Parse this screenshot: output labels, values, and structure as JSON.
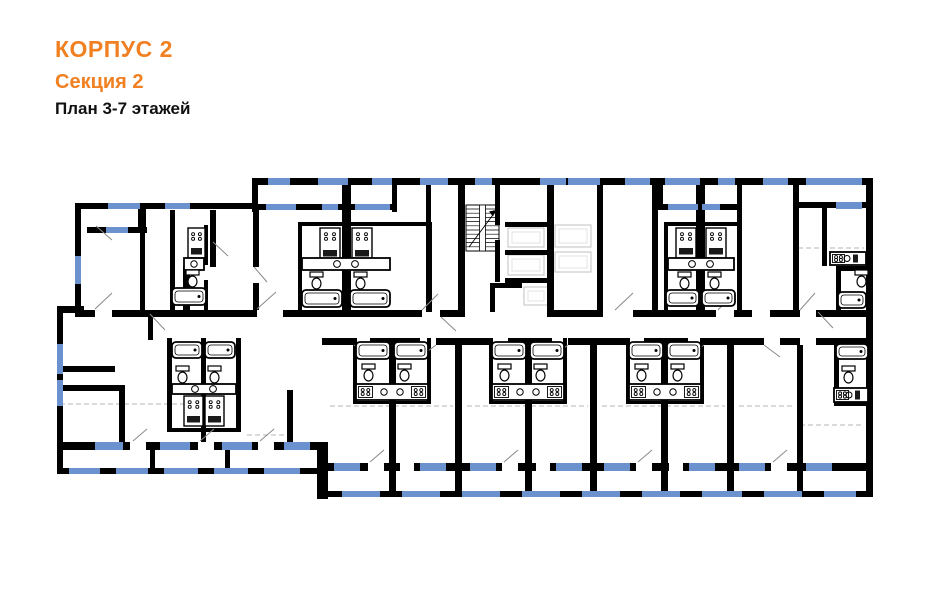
{
  "header": {
    "building": "КОРПУС 2",
    "section": "Секция 2",
    "floors": "План 3-7 этажей"
  },
  "colors": {
    "accent_orange": "#F08021",
    "wall_black": "#000000",
    "window_blue": "#6B92CF",
    "dash_gray": "#B5B5B5",
    "door_gray": "#8A8A8A",
    "lift_gray": "#C0C0C0",
    "lift_gray_light": "#DCDCDC",
    "background": "#FFFFFF"
  },
  "plan": {
    "canvas": {
      "w": 941,
      "h": 600
    },
    "walls": [
      [
        252,
        178,
        621,
        7
      ],
      [
        75,
        203,
        182,
        6
      ],
      [
        866,
        178,
        7,
        319
      ],
      [
        75,
        203,
        6,
        110
      ],
      [
        57,
        306,
        27,
        7
      ],
      [
        57,
        306,
        6,
        168
      ],
      [
        57,
        442,
        266,
        8
      ],
      [
        317,
        442,
        11,
        57
      ],
      [
        322,
        463,
        548,
        8
      ],
      [
        87,
        227,
        60,
        6
      ],
      [
        138,
        203,
        8,
        30
      ],
      [
        255,
        204,
        140,
        6
      ],
      [
        658,
        204,
        82,
        6
      ],
      [
        795,
        202,
        71,
        6
      ],
      [
        252,
        178,
        6,
        34
      ],
      [
        392,
        178,
        5,
        34
      ],
      [
        658,
        178,
        5,
        30
      ],
      [
        342,
        185,
        9,
        127
      ],
      [
        426,
        185,
        5,
        127
      ],
      [
        458,
        185,
        7,
        132
      ],
      [
        495,
        185,
        5,
        40
      ],
      [
        495,
        240,
        5,
        42
      ],
      [
        547,
        185,
        7,
        132
      ],
      [
        505,
        222,
        47,
        5
      ],
      [
        505,
        250,
        47,
        5
      ],
      [
        505,
        278,
        47,
        5
      ],
      [
        490,
        283,
        5,
        29
      ],
      [
        490,
        283,
        32,
        5
      ],
      [
        597,
        185,
        6,
        127
      ],
      [
        652,
        185,
        6,
        127
      ],
      [
        696,
        185,
        9,
        127
      ],
      [
        737,
        178,
        5,
        134
      ],
      [
        793,
        178,
        6,
        134
      ],
      [
        822,
        208,
        5,
        58
      ],
      [
        210,
        210,
        6,
        57
      ],
      [
        253,
        210,
        6,
        57
      ],
      [
        253,
        283,
        6,
        27
      ],
      [
        170,
        210,
        5,
        100
      ],
      [
        204,
        225,
        4,
        40
      ],
      [
        204,
        280,
        4,
        30
      ],
      [
        183,
        272,
        7,
        38
      ],
      [
        183,
        266,
        14,
        7
      ],
      [
        140,
        231,
        5,
        80
      ],
      [
        298,
        222,
        134,
        4
      ],
      [
        298,
        222,
        4,
        90
      ],
      [
        428,
        222,
        4,
        90
      ],
      [
        664,
        222,
        78,
        4
      ],
      [
        664,
        222,
        4,
        90
      ],
      [
        836,
        266,
        32,
        5
      ],
      [
        836,
        266,
        5,
        44
      ],
      [
        75,
        310,
        20,
        7
      ],
      [
        112,
        310,
        58,
        7
      ],
      [
        170,
        310,
        87,
        7
      ],
      [
        283,
        310,
        37,
        7
      ],
      [
        320,
        310,
        102,
        7
      ],
      [
        440,
        310,
        18,
        7
      ],
      [
        553,
        310,
        50,
        7
      ],
      [
        633,
        310,
        19,
        7
      ],
      [
        652,
        310,
        64,
        7
      ],
      [
        734,
        310,
        18,
        7
      ],
      [
        770,
        310,
        30,
        7
      ],
      [
        816,
        310,
        50,
        7
      ],
      [
        322,
        338,
        32,
        7
      ],
      [
        370,
        338,
        50,
        7
      ],
      [
        436,
        338,
        56,
        7
      ],
      [
        508,
        338,
        44,
        7
      ],
      [
        568,
        338,
        60,
        7
      ],
      [
        644,
        338,
        44,
        7
      ],
      [
        704,
        338,
        60,
        7
      ],
      [
        780,
        338,
        20,
        7
      ],
      [
        816,
        338,
        50,
        7
      ],
      [
        57,
        366,
        58,
        6
      ],
      [
        63,
        385,
        60,
        6
      ],
      [
        119,
        385,
        6,
        60
      ],
      [
        148,
        313,
        5,
        27
      ],
      [
        287,
        390,
        6,
        54
      ],
      [
        167,
        338,
        5,
        92
      ],
      [
        236,
        338,
        5,
        92
      ],
      [
        201,
        338,
        5,
        104
      ],
      [
        167,
        428,
        74,
        4
      ],
      [
        389,
        345,
        7,
        146
      ],
      [
        455,
        345,
        7,
        146
      ],
      [
        525,
        345,
        7,
        146
      ],
      [
        590,
        345,
        7,
        146
      ],
      [
        661,
        345,
        7,
        146
      ],
      [
        727,
        345,
        7,
        146
      ],
      [
        797,
        345,
        6,
        146
      ],
      [
        834,
        338,
        5,
        66
      ],
      [
        353,
        338,
        4,
        65
      ],
      [
        427,
        338,
        4,
        65
      ],
      [
        353,
        401,
        78,
        3
      ],
      [
        489,
        338,
        4,
        65
      ],
      [
        563,
        338,
        4,
        65
      ],
      [
        489,
        401,
        78,
        3
      ],
      [
        626,
        338,
        4,
        65
      ],
      [
        700,
        338,
        4,
        65
      ],
      [
        626,
        401,
        78,
        3
      ],
      [
        834,
        402,
        36,
        4
      ],
      [
        150,
        450,
        5,
        18
      ],
      [
        225,
        450,
        5,
        18
      ]
    ],
    "gaps": [
      [
        130,
        442,
        16,
        8
      ],
      [
        198,
        442,
        16,
        8
      ],
      [
        258,
        442,
        16,
        8
      ],
      [
        368,
        463,
        16,
        8
      ],
      [
        400,
        463,
        14,
        8
      ],
      [
        502,
        463,
        16,
        8
      ],
      [
        536,
        463,
        14,
        8
      ],
      [
        636,
        463,
        16,
        8
      ],
      [
        669,
        463,
        14,
        8
      ],
      [
        771,
        463,
        16,
        8
      ]
    ],
    "glazing": [
      [
        57,
        468,
        266,
        6
      ],
      [
        322,
        491,
        551,
        6
      ]
    ],
    "windows": [
      [
        268,
        178,
        22,
        7
      ],
      [
        318,
        178,
        30,
        7
      ],
      [
        372,
        178,
        20,
        7
      ],
      [
        420,
        178,
        28,
        7
      ],
      [
        475,
        178,
        17,
        7
      ],
      [
        540,
        178,
        26,
        7
      ],
      [
        568,
        178,
        32,
        7
      ],
      [
        625,
        178,
        25,
        7
      ],
      [
        665,
        178,
        35,
        7
      ],
      [
        718,
        178,
        17,
        7
      ],
      [
        763,
        178,
        25,
        7
      ],
      [
        806,
        178,
        56,
        7
      ],
      [
        108,
        203,
        32,
        6
      ],
      [
        165,
        203,
        25,
        6
      ],
      [
        266,
        204,
        30,
        6
      ],
      [
        322,
        204,
        16,
        6
      ],
      [
        355,
        204,
        35,
        6
      ],
      [
        668,
        204,
        30,
        6
      ],
      [
        702,
        204,
        18,
        6
      ],
      [
        836,
        202,
        26,
        7
      ],
      [
        106,
        227,
        22,
        6
      ],
      [
        75,
        256,
        6,
        28
      ],
      [
        57,
        344,
        6,
        30
      ],
      [
        57,
        380,
        6,
        26
      ],
      [
        95,
        442,
        28,
        8
      ],
      [
        160,
        442,
        30,
        8
      ],
      [
        222,
        442,
        30,
        8
      ],
      [
        284,
        442,
        26,
        8
      ],
      [
        334,
        463,
        26,
        8
      ],
      [
        420,
        463,
        26,
        8
      ],
      [
        470,
        463,
        26,
        8
      ],
      [
        556,
        463,
        26,
        8
      ],
      [
        604,
        463,
        26,
        8
      ],
      [
        689,
        463,
        26,
        8
      ],
      [
        739,
        463,
        26,
        8
      ],
      [
        806,
        463,
        26,
        8
      ]
    ],
    "posts": [
      [
        57,
        468,
        12,
        6
      ],
      [
        100,
        468,
        16,
        6
      ],
      [
        148,
        468,
        16,
        6
      ],
      [
        198,
        468,
        16,
        6
      ],
      [
        248,
        468,
        16,
        6
      ],
      [
        300,
        468,
        23,
        6
      ],
      [
        322,
        491,
        20,
        6
      ],
      [
        380,
        491,
        22,
        6
      ],
      [
        440,
        491,
        22,
        6
      ],
      [
        500,
        491,
        22,
        6
      ],
      [
        560,
        491,
        22,
        6
      ],
      [
        620,
        491,
        22,
        6
      ],
      [
        680,
        491,
        22,
        6
      ],
      [
        742,
        491,
        22,
        6
      ],
      [
        802,
        491,
        22,
        6
      ],
      [
        856,
        491,
        17,
        6
      ]
    ],
    "dashes": [
      [
        60,
        404,
        192,
        404
      ],
      [
        247,
        435,
        290,
        435
      ],
      [
        330,
        406,
        453,
        406
      ],
      [
        467,
        406,
        588,
        406
      ],
      [
        602,
        406,
        725,
        406
      ],
      [
        739,
        406,
        795,
        406
      ],
      [
        800,
        425,
        864,
        425
      ],
      [
        798,
        248,
        864,
        248
      ]
    ],
    "doors": [
      [
        95,
        309,
        112,
        293
      ],
      [
        257,
        309,
        276,
        292
      ],
      [
        267,
        282,
        254,
        267
      ],
      [
        422,
        310,
        438,
        294
      ],
      [
        441,
        317,
        456,
        331
      ],
      [
        615,
        310,
        633,
        293
      ],
      [
        718,
        310,
        733,
        294
      ],
      [
        800,
        310,
        815,
        293
      ],
      [
        354,
        345,
        370,
        357
      ],
      [
        420,
        357,
        436,
        345
      ],
      [
        493,
        345,
        509,
        357
      ],
      [
        552,
        357,
        568,
        345
      ],
      [
        630,
        345,
        646,
        357
      ],
      [
        688,
        357,
        704,
        345
      ],
      [
        764,
        345,
        780,
        357
      ],
      [
        133,
        441,
        147,
        429
      ],
      [
        200,
        441,
        214,
        429
      ],
      [
        260,
        441,
        274,
        429
      ],
      [
        370,
        462,
        384,
        450
      ],
      [
        504,
        462,
        518,
        450
      ],
      [
        638,
        462,
        652,
        450
      ],
      [
        773,
        462,
        787,
        450
      ],
      [
        213,
        242,
        228,
        256
      ],
      [
        150,
        314,
        165,
        330
      ],
      [
        96,
        226,
        112,
        240
      ],
      [
        818,
        312,
        833,
        328
      ]
    ],
    "lifts": [
      [
        508,
        228,
        36,
        19
      ],
      [
        508,
        255,
        36,
        20
      ],
      [
        555,
        225,
        36,
        22
      ],
      [
        555,
        252,
        36,
        20
      ],
      [
        524,
        287,
        24,
        18
      ]
    ],
    "stair": {
      "x": 466,
      "y": 205,
      "w": 33,
      "h": 46
    },
    "fixtures": [
      [
        "stove",
        188,
        228,
        17,
        30
      ],
      [
        "stove",
        320,
        228,
        20,
        32
      ],
      [
        "stove",
        352,
        228,
        20,
        32
      ],
      [
        "stove",
        676,
        228,
        20,
        30
      ],
      [
        "stove",
        706,
        228,
        20,
        30
      ],
      [
        "stove",
        184,
        396,
        19,
        30
      ],
      [
        "stove",
        205,
        396,
        19,
        30
      ],
      [
        "counter",
        184,
        258,
        20,
        12,
        0
      ],
      [
        "counter",
        302,
        258,
        88,
        12,
        1
      ],
      [
        "counter",
        668,
        258,
        66,
        12,
        1
      ],
      [
        "counter",
        830,
        252,
        36,
        13,
        3
      ],
      [
        "counter",
        356,
        384,
        72,
        16,
        2
      ],
      [
        "counter",
        492,
        384,
        72,
        16,
        2
      ],
      [
        "counter",
        629,
        384,
        72,
        16,
        2
      ],
      [
        "counter",
        834,
        388,
        34,
        14,
        3
      ],
      [
        "counter",
        172,
        384,
        64,
        10,
        1
      ],
      [
        "wc",
        186,
        270
      ],
      [
        "wc",
        310,
        272
      ],
      [
        "wc",
        354,
        272
      ],
      [
        "wc",
        678,
        272
      ],
      [
        "wc",
        708,
        272
      ],
      [
        "wc",
        855,
        270
      ],
      [
        "wc",
        362,
        364
      ],
      [
        "wc",
        398,
        364
      ],
      [
        "wc",
        498,
        364
      ],
      [
        "wc",
        534,
        364
      ],
      [
        "wc",
        635,
        364
      ],
      [
        "wc",
        671,
        364
      ],
      [
        "wc",
        842,
        366
      ],
      [
        "wc",
        176,
        366
      ],
      [
        "wc",
        208,
        366
      ],
      [
        "tub",
        172,
        288,
        34,
        17
      ],
      [
        "tub",
        302,
        290,
        40,
        17
      ],
      [
        "tub",
        350,
        290,
        40,
        17
      ],
      [
        "tub",
        666,
        290,
        33,
        16
      ],
      [
        "tub",
        702,
        290,
        33,
        16
      ],
      [
        "tub",
        838,
        292,
        28,
        16
      ],
      [
        "tub",
        356,
        342,
        34,
        17
      ],
      [
        "tub",
        394,
        342,
        34,
        17
      ],
      [
        "tub",
        492,
        342,
        34,
        17
      ],
      [
        "tub",
        530,
        342,
        34,
        17
      ],
      [
        "tub",
        629,
        342,
        34,
        17
      ],
      [
        "tub",
        667,
        342,
        34,
        17
      ],
      [
        "tub",
        172,
        342,
        30,
        16
      ],
      [
        "tub",
        205,
        342,
        30,
        16
      ],
      [
        "tub",
        836,
        344,
        32,
        15
      ]
    ]
  }
}
